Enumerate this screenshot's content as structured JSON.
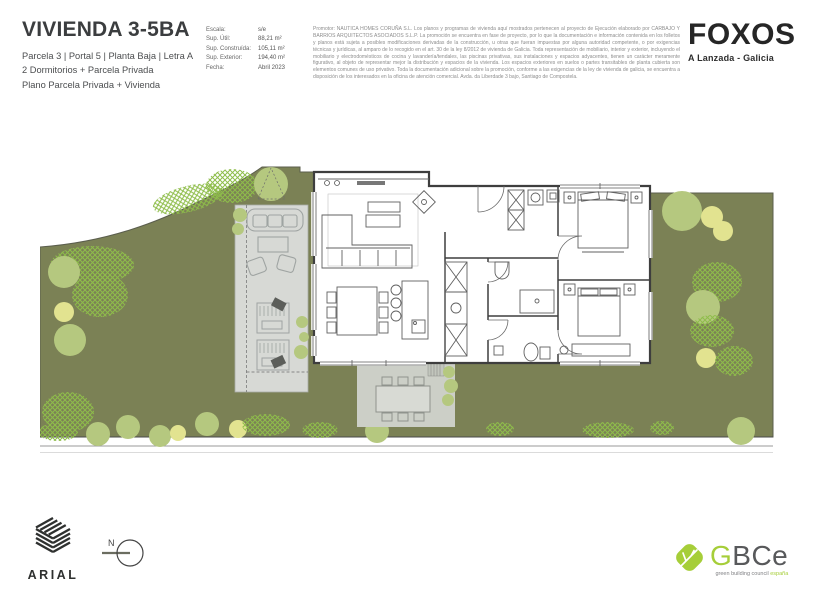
{
  "header": {
    "title": "VIVIENDA 3-5BA",
    "subtitle_line1": "Parcela 3 | Portal 5 | Planta Baja | Letra A",
    "subtitle_line2": "2 Dormitorios + Parcela Privada",
    "subtitle_line3": "Plano Parcela Privada + Vivienda",
    "specs": [
      {
        "label": "Escala:",
        "value": "s/e"
      },
      {
        "label": "Sup. Útil:",
        "value": "88,21 m²"
      },
      {
        "label": "Sup. Construída:",
        "value": "105,11 m²"
      },
      {
        "label": "Sup. Exterior:",
        "value": "194,40 m²"
      },
      {
        "label": "Fecha:",
        "value": "Abril 2023"
      }
    ],
    "legal_text": "Promotor: NAUTICA HOMES CORUÑA S.L. Los planos y programas de vivienda aquí mostrados pertenecen al proyecto de Ejecución elaborado por CARBAJO Y BARRIOS ARQUITECTOS ASOCIADOS S.L.P. La promoción se encuentra en fase de proyecto, por lo que la documentación e información contenida en los folletos y planos está sujeta a posibles modificaciones derivadas de la construcción, u otras que fueran impuestas por alguna autoridad competente, o por exigencias técnicas y jurídicas, al amparo de lo recogido en el art. 30 de la ley 8/2012 de vivienda de Galicia. Toda representación de mobiliario, interior y exterior, incluyendo el mobiliario y electrodomésticos de cocina y lavandería/tendales, las piscinas privativas, sus instalaciones y espacios adyacentes, tienen un carácter meramente figurativo, al objeto de representar mejor la distribución y espacios de la vivienda. Los espacios exteriores en suelos o partes transitables de planta cubierta son elementos comunes de uso privativo. Toda la documentación adicional sobre la promoción, conforme a las exigencias de la ley de vivienda de galicia, se encuentra a disposición de los interesados en la oficina de atención comercial. Avda. da Liberdade 3 bajo, Santiago de Compostela.",
    "brand": {
      "name": "FOXOS",
      "location": "A Lanzada - Galicia"
    }
  },
  "footer": {
    "studio_name": "ARIAL",
    "compass_label": "N",
    "certification": {
      "letter_green": "G",
      "letters_gray": "BCe",
      "tagline_gray": "green building council ",
      "tagline_green": "españa"
    }
  },
  "palette": {
    "garden_green": "#7b8155",
    "tree_sage": "#b5c87f",
    "tree_yellow": "#e2e390",
    "shrub_hatch_green": "#8ebd4a",
    "deck_gray": "#d7d9d5",
    "patio_gray": "#cccfc7",
    "wall_dark": "#3e3e3e",
    "gbce_green": "#a6ce39",
    "text_dark": "#3b3d3f",
    "text_gray": "#8d8d8d"
  }
}
